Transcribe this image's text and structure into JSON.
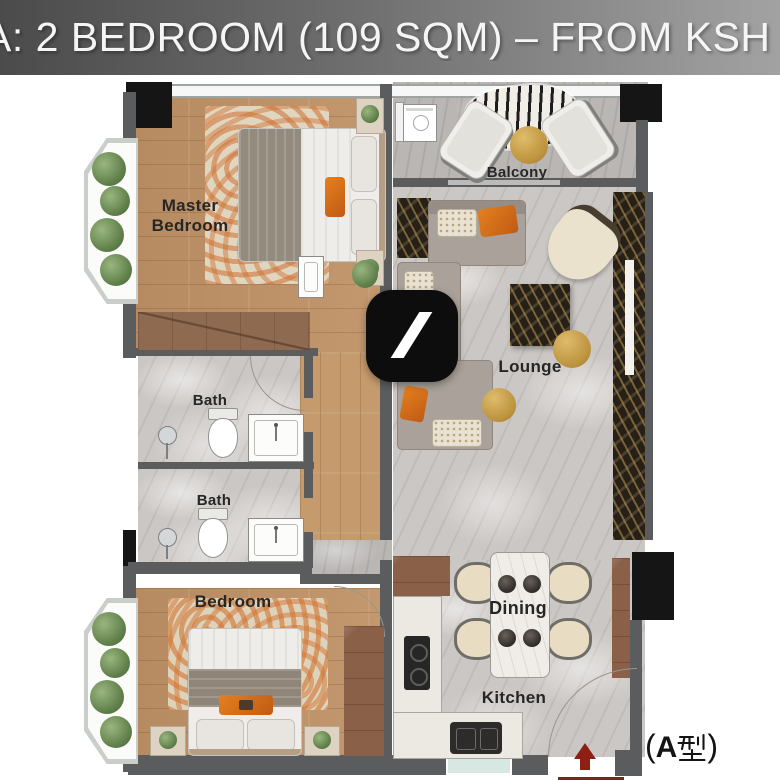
{
  "header": {
    "title": "A: 2 BEDROOM (109 SQM) – FROM KSH 1"
  },
  "plan": {
    "rooms": [
      {
        "id": "master-bedroom",
        "label": "Master Bedroom"
      },
      {
        "id": "balcony",
        "label": "Balcony"
      },
      {
        "id": "lounge",
        "label": "Lounge"
      },
      {
        "id": "bath-1",
        "label": "Bath"
      },
      {
        "id": "bath-2",
        "label": "Bath"
      },
      {
        "id": "bedroom",
        "label": "Bedroom"
      },
      {
        "id": "dining",
        "label": "Dining"
      },
      {
        "id": "kitchen",
        "label": "Kitchen"
      }
    ],
    "type_label": {
      "full": "(A型)",
      "open_paren": "(",
      "letter": "A",
      "kanji": "型",
      "close_paren": ")"
    },
    "logo": "black-rounded-square-with-white-slash",
    "entrance_marker": "red-up-arrow"
  },
  "colors": {
    "header_gradient_left": "#4b4b4b",
    "header_gradient_right": "#a2a2a2",
    "wall_gray": "#5b5c5e",
    "wall_black": "#151515",
    "wood_floor": "#c09266",
    "marble_floor": "#cbc7c4",
    "dark_marble": "#262017",
    "accent_orange": "#cd6a22",
    "accent_gold": "#c7a04e",
    "plant_green": "#6d8c58",
    "entrance_red": "#8e1f14"
  }
}
